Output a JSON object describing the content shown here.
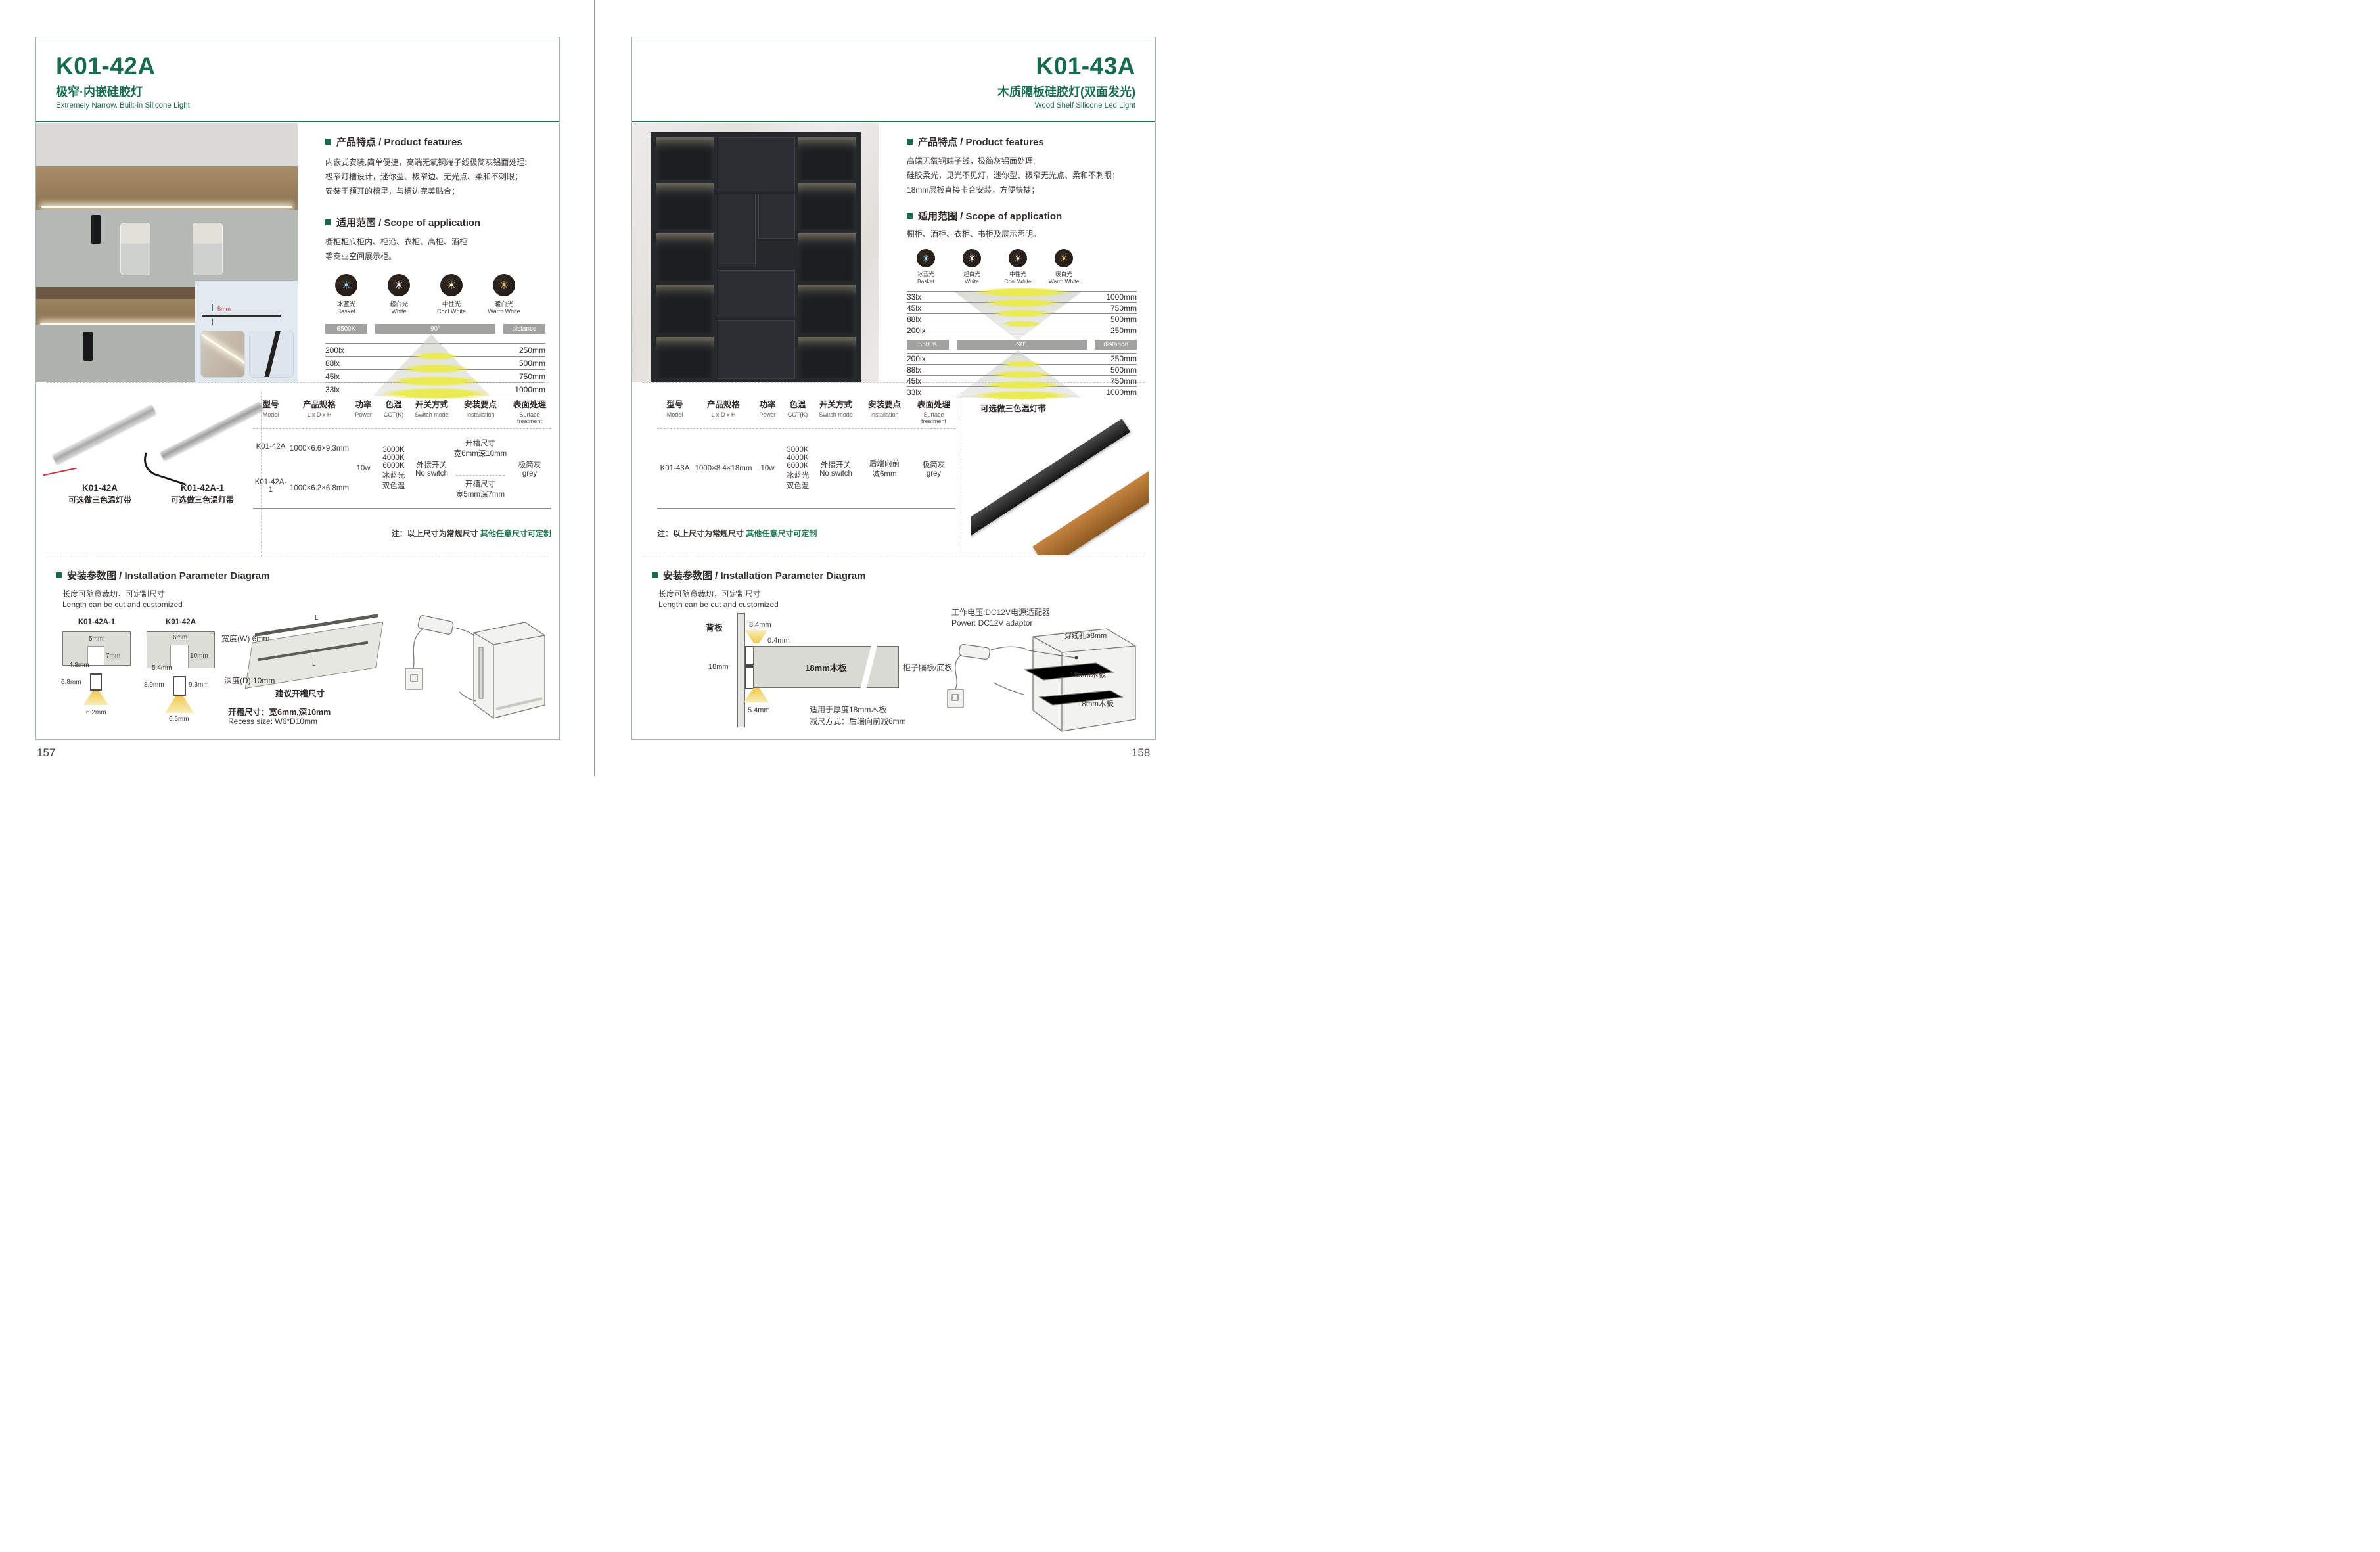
{
  "pages": [
    {
      "page_number": "157",
      "header": {
        "model": "K01-42A",
        "title_cn": "极窄·内嵌硅胶灯",
        "title_en": "Extremely Narrow. Built-in Silicone Light"
      },
      "photo": {
        "strip_dim": "5mm"
      },
      "features": {
        "heading": "产品特点 / Product features",
        "lines": [
          "内嵌式安装,简单便捷，高端无氧铜端子线极简灰铝面处理;",
          "极窄灯槽设计，迷你型、极窄边、无光点、柔和不刺眼；",
          "安装于预开的槽里，与槽边完美贴合；"
        ]
      },
      "scope": {
        "heading": "适用范围 / Scope of application",
        "lines": [
          "橱柜柜底柜内、柜沿、衣柜、高柜、酒柜",
          "等商业空间展示柜。"
        ]
      },
      "icons": [
        {
          "cn": "冰蓝光",
          "en": "Basket",
          "color": "#9fd7f2"
        },
        {
          "cn": "超白光",
          "en": "White",
          "color": "#ffffff"
        },
        {
          "cn": "中性光",
          "en": "Cool White",
          "color": "#f7edd2"
        },
        {
          "cn": "暖白光",
          "en": "Warm White",
          "color": "#f2c97d"
        }
      ],
      "photometric": {
        "kelvin": "6500K",
        "angle": "90°",
        "distance": "distance",
        "rows": [
          {
            "lux": "200lx",
            "mm": "250mm"
          },
          {
            "lux": "88lx",
            "mm": "500mm"
          },
          {
            "lux": "45lx",
            "mm": "750mm"
          },
          {
            "lux": "33lx",
            "mm": "1000mm"
          }
        ]
      },
      "products": [
        {
          "model": "K01-42A",
          "note": "可选做三色温灯带"
        },
        {
          "model": "K01-42A-1",
          "note": "可选做三色温灯带"
        }
      ],
      "spec": {
        "headers": [
          {
            "cn": "型号",
            "en": "Model"
          },
          {
            "cn": "产品规格",
            "en": "L x D x H"
          },
          {
            "cn": "功率",
            "en": "Power"
          },
          {
            "cn": "色温",
            "en": "CCT(K)"
          },
          {
            "cn": "开关方式",
            "en": "Switch mode"
          },
          {
            "cn": "安装要点",
            "en": "Installation"
          },
          {
            "cn": "表面处理",
            "en": "Surface treatment"
          }
        ],
        "rows": [
          {
            "model": "K01-42A",
            "size": "1000×6.6×9.3mm",
            "install": "开槽尺寸\n宽6mm深10mm"
          },
          {
            "model": "K01-42A-1",
            "size": "1000×6.2×6.8mm",
            "install": "开槽尺寸\n宽5mm深7mm"
          }
        ],
        "power": "10w",
        "cct": "3000K\n4000K\n6000K\n冰蓝光\n双色温",
        "switch": "外接开关\nNo switch",
        "surface": "极简灰\ngrey"
      },
      "note": {
        "prefix": "注：以上尺寸为常规尺寸 ",
        "highlight": "其他任意尺寸可定制"
      },
      "install": {
        "heading": "安装参数图 / Installation Parameter Diagram",
        "cut_cn": "长度可随意裁切，可定制尺寸",
        "cut_en": "Length can be cut and customized",
        "sections": [
          {
            "model": "K01-42A-1",
            "slot_w": "5mm",
            "slot_d": "7mm",
            "slot_bottom": "4.8mm",
            "profile_h": "6.8mm",
            "profile_w": "6.2mm"
          },
          {
            "model": "K01-42A",
            "slot_w": "6mm",
            "slot_d": "10mm",
            "slot_bottom": "5.4mm",
            "profile_h": "8.9mm",
            "profile_h2": "9.3mm",
            "profile_w": "6.6mm"
          }
        ],
        "board": {
          "width": "宽度(W) 6mm",
          "depth": "深度(D) 10mm",
          "suggest": "建议开槽尺寸",
          "len_top": "L",
          "len_in": "L"
        },
        "recess_cn": "开槽尺寸：宽6mm,深10mm",
        "recess_en": "Recess size: W6*D10mm"
      }
    },
    {
      "page_number": "158",
      "header": {
        "model": "K01-43A",
        "title_cn": "木质隔板硅胶灯(双面发光)",
        "title_en": "Wood Shelf Silicone Led Light"
      },
      "features": {
        "heading": "产品特点 / Product features",
        "lines": [
          "高端无氧铜端子线，极简灰铝面处理;",
          "硅胶柔光，见光不见灯，迷你型、极窄无光点、柔和不刺眼；",
          "18mm层板直接卡合安装，方便快捷；"
        ]
      },
      "scope": {
        "heading": "适用范围 / Scope of application",
        "lines": [
          "橱柜、酒柜、衣柜、书柜及展示照明。"
        ]
      },
      "icons": [
        {
          "cn": "冰蓝光",
          "en": "Basket",
          "color": "#9fd7f2"
        },
        {
          "cn": "超白光",
          "en": "White",
          "color": "#ffffff"
        },
        {
          "cn": "中性光",
          "en": "Cool White",
          "color": "#f7edd2"
        },
        {
          "cn": "暖白光",
          "en": "Warm White",
          "color": "#f2c97d"
        }
      ],
      "photometric": {
        "kelvin": "6500K",
        "angle": "90°",
        "distance": "distance",
        "rows_top": [
          {
            "lux": "33lx",
            "mm": "1000mm"
          },
          {
            "lux": "45lx",
            "mm": "750mm"
          },
          {
            "lux": "88lx",
            "mm": "500mm"
          },
          {
            "lux": "200lx",
            "mm": "250mm"
          }
        ],
        "rows": [
          {
            "lux": "200lx",
            "mm": "250mm"
          },
          {
            "lux": "88lx",
            "mm": "500mm"
          },
          {
            "lux": "45lx",
            "mm": "750mm"
          },
          {
            "lux": "33lx",
            "mm": "1000mm"
          }
        ]
      },
      "product_note": "可选做三色温灯带",
      "spec": {
        "headers": [
          {
            "cn": "型号",
            "en": "Model"
          },
          {
            "cn": "产品规格",
            "en": "L x D x H"
          },
          {
            "cn": "功率",
            "en": "Power"
          },
          {
            "cn": "色温",
            "en": "CCT(K)"
          },
          {
            "cn": "开关方式",
            "en": "Switch mode"
          },
          {
            "cn": "安装要点",
            "en": "Installation"
          },
          {
            "cn": "表面处理",
            "en": "Surface treatment"
          }
        ],
        "rows": [
          {
            "model": "K01-43A",
            "size": "1000×8.4×18mm",
            "install": "后端向前\n减6mm"
          }
        ],
        "power": "10w",
        "cct": "3000K\n4000K\n6000K\n冰蓝光\n双色温",
        "switch": "外接开关\nNo switch",
        "surface": "极简灰\ngrey"
      },
      "note": {
        "prefix": "注：以上尺寸为常规尺寸 ",
        "highlight": "其他任意尺寸可定制"
      },
      "install": {
        "heading": "安装参数图 / Installation Parameter Diagram",
        "cut_cn": "长度可随意裁切，可定制尺寸",
        "cut_en": "Length can be cut and customized",
        "back_label": "背板",
        "dim_top": "8.4mm",
        "dim_gap": "0.4mm",
        "dim_thickness": "18mm",
        "dim_bottom": "5.4mm",
        "board_label": "18mm木板",
        "shelf_label": "柜子隔板/底板",
        "fit_note1": "适用于厚度18mm木板",
        "fit_note2": "减尺方式：后端向前减6mm",
        "power_cn": "工作电压:DC12V电源适配器",
        "power_en": "Power: DC12V adaptor",
        "hole_label": "穿线孔ø8mm",
        "shelf1_label": "18mm木板",
        "shelf2_label": "18mm木板"
      }
    }
  ]
}
